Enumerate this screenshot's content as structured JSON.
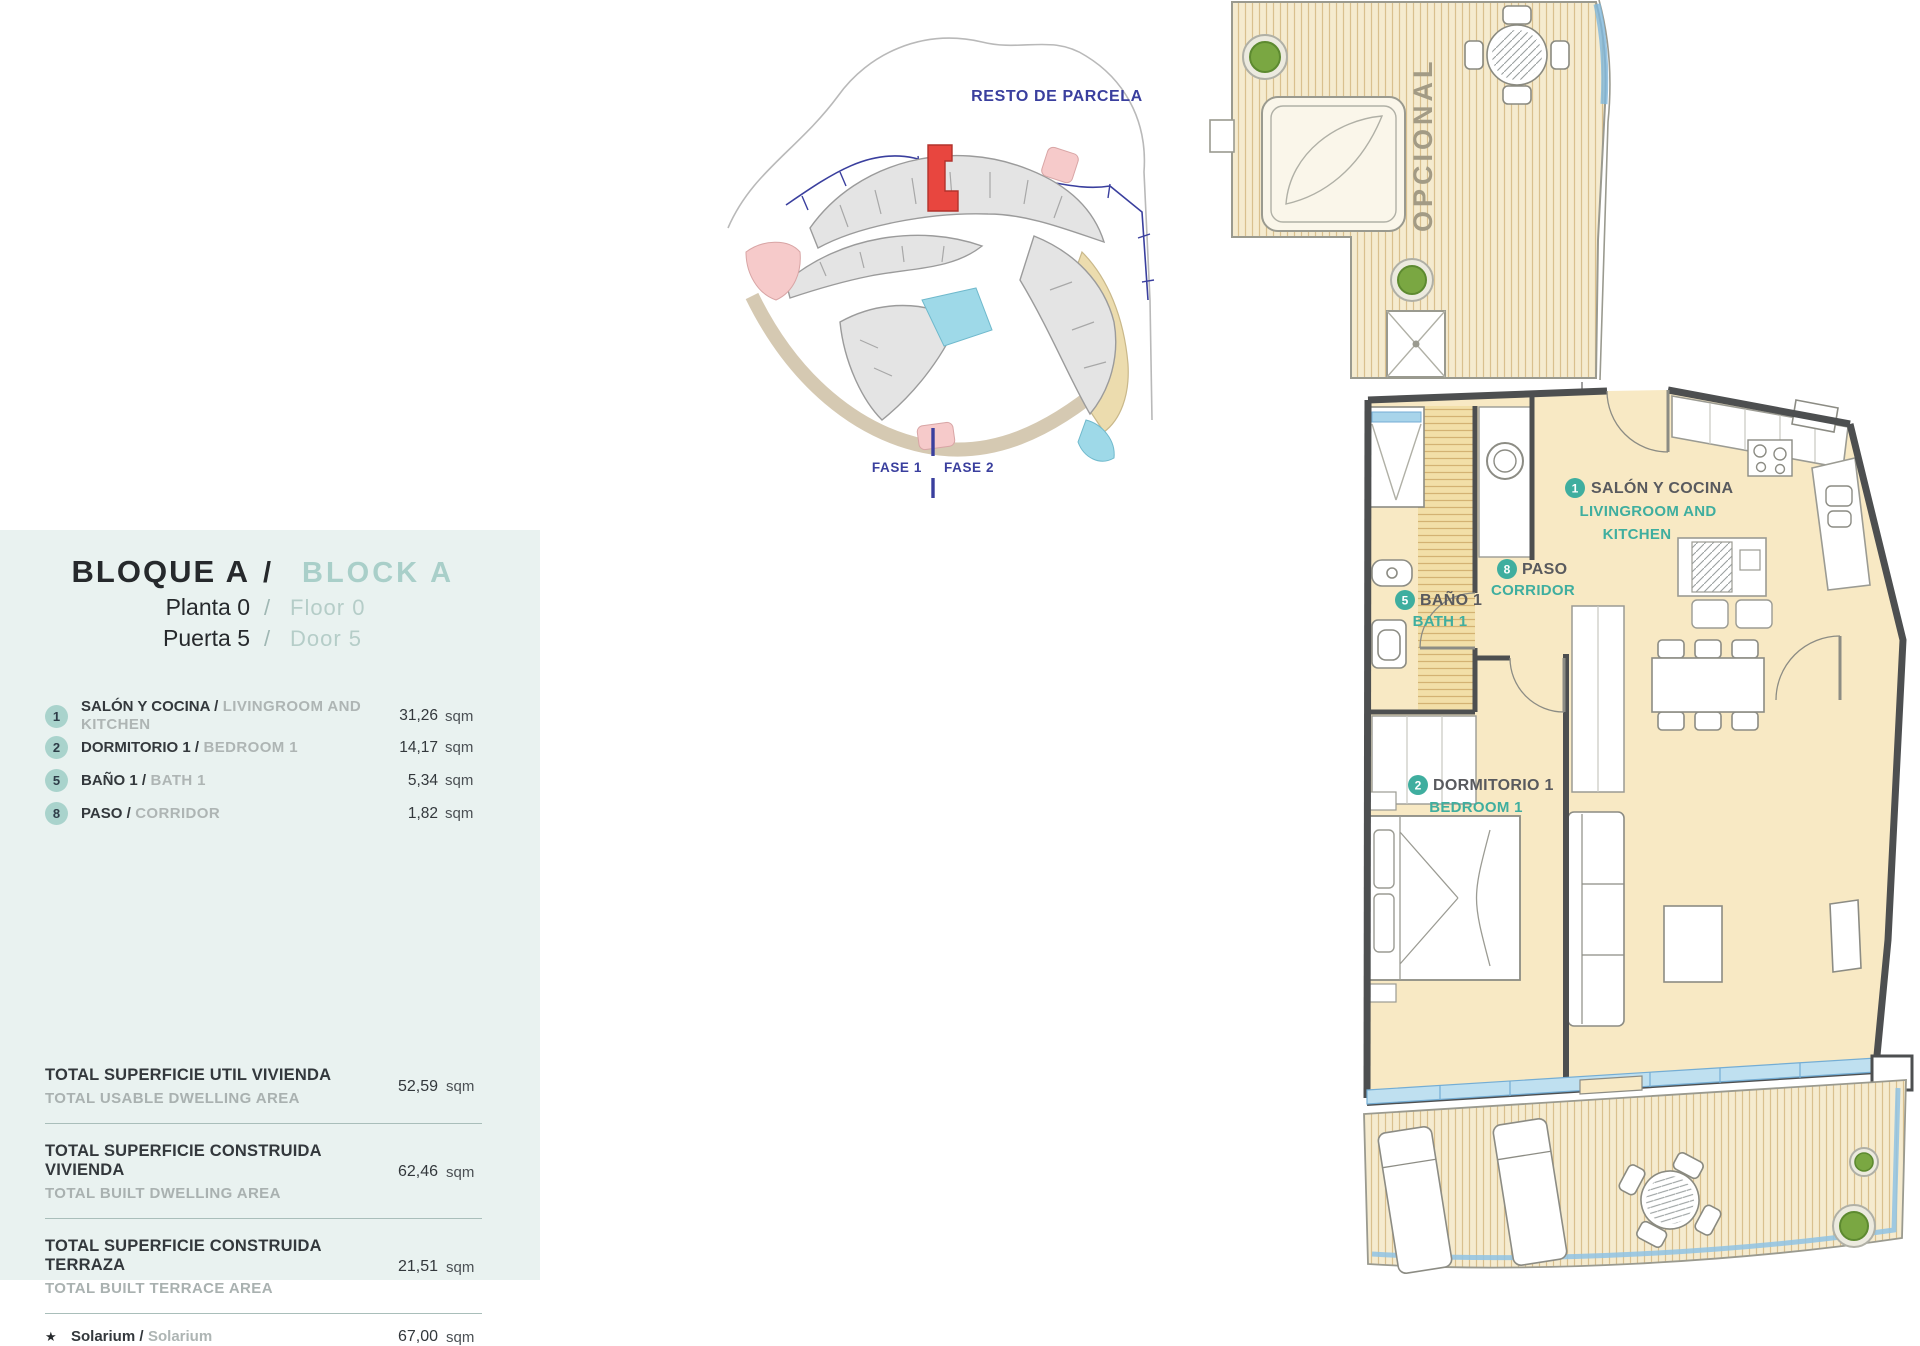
{
  "colors": {
    "accent_teal": "#3fae9f",
    "light_teal": "#a9d3cc",
    "panel_bg": "#e9f2f0",
    "blue": "#3a3f9e",
    "red": "#e8463f",
    "room_fill": "#f8e9c4",
    "deck_fill": "#f5ebcf",
    "wall": "#4d4f50",
    "glass": "#bfe0f0"
  },
  "info_panel": {
    "title": {
      "es": "BLOQUE A",
      "sep": "/",
      "en": "BLOCK A"
    },
    "floor": {
      "es": "Planta 0",
      "sep": "/",
      "en": "Floor 0"
    },
    "door": {
      "es": "Puerta 5",
      "sep": "/",
      "en": "Door 5"
    },
    "rooms": [
      {
        "num": "1",
        "es": "SALÓN Y COCINA /",
        "en": "LIVINGROOM AND KITCHEN",
        "area": "31,26",
        "unit": "sqm"
      },
      {
        "num": "2",
        "es": "DORMITORIO 1 /",
        "en": "BEDROOM 1",
        "area": "14,17",
        "unit": "sqm"
      },
      {
        "num": "5",
        "es": "BAÑO 1 /",
        "en": "BATH 1",
        "area": "5,34",
        "unit": "sqm"
      },
      {
        "num": "8",
        "es": "PASO /",
        "en": "CORRIDOR",
        "area": "1,82",
        "unit": "sqm"
      }
    ],
    "totals": [
      {
        "es": "TOTAL SUPERFICIE UTIL VIVIENDA",
        "en": "TOTAL USABLE DWELLING AREA",
        "value": "52,59",
        "unit": "sqm"
      },
      {
        "es": "TOTAL SUPERFICIE CONSTRUIDA VIVIENDA",
        "en": "TOTAL BUILT DWELLING AREA",
        "value": "62,46",
        "unit": "sqm"
      },
      {
        "es": "TOTAL SUPERFICIE CONSTRUIDA TERRAZA",
        "en": "TOTAL BUILT TERRACE AREA",
        "value": "21,51",
        "unit": "sqm"
      }
    ],
    "partial_row": {
      "icon": "★",
      "es": "Solarium /",
      "en": "Solarium",
      "value": "67,00",
      "unit": "sqm"
    }
  },
  "site_plan": {
    "resto": "RESTO DE PARCELA",
    "fase1": "FASE 1",
    "fase2": "FASE 2"
  },
  "floor_plan": {
    "livingroom": {
      "num": "1",
      "es": "SALÓN Y COCINA",
      "en1": "LIVINGROOM AND",
      "en2": "KITCHEN"
    },
    "corridor": {
      "num": "8",
      "es": "PASO",
      "en": "CORRIDOR"
    },
    "bath": {
      "num": "5",
      "es": "BAÑO 1",
      "en": "BATH 1"
    },
    "bedroom": {
      "num": "2",
      "es": "DORMITORIO 1",
      "en": "BEDROOM 1"
    },
    "optional": "OPCIONAL"
  }
}
